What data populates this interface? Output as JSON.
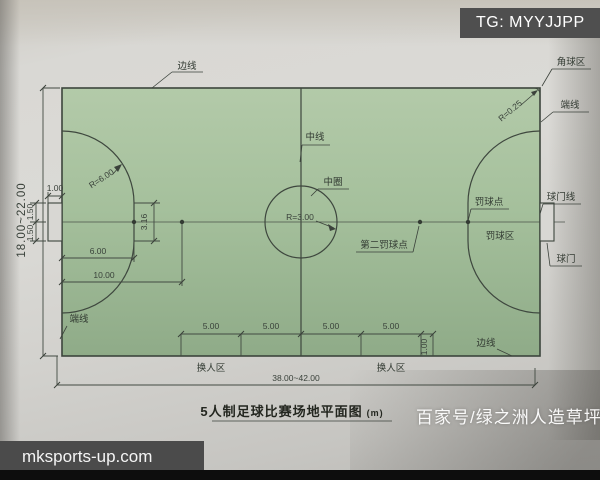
{
  "watermarks": {
    "telegram": "TG: MYYJJPP",
    "site": "mksports-up.com",
    "source": "百家号/绿之洲人造草坪"
  },
  "title": {
    "text": "5人制足球比赛场地平面图",
    "unit": "(m)"
  },
  "labels": {
    "sideline_top": "边线",
    "sideline_bottom": "边线",
    "endline_right": "端线",
    "endline_left": "端线",
    "corner_area": "角球区",
    "center_line": "中线",
    "center_circle": "中圈",
    "second_penalty_point": "第二罚球点",
    "penalty_point": "罚球点",
    "penalty_area": "罚球区",
    "goal_line": "球门线",
    "goal": "球门",
    "substitution_zone_left": "换人区",
    "substitution_zone_right": "换人区"
  },
  "dimensions": {
    "field_width_range": "18.00~22.00",
    "field_length_range": "38.00~42.00",
    "corner_arc_radius": "R=0.25",
    "center_circle_radius": "R=3.00",
    "penalty_arc_radius": "R=6.00",
    "goal_depth": "1.00",
    "goal_half_width_upper": "1.50",
    "goal_half_width_lower": "1.50",
    "arc_flat_length": "3.16",
    "penalty_mark_distance": "6.00",
    "second_penalty_mark_distance": "10.00",
    "sub_zone_seg1": "5.00",
    "sub_zone_seg2": "5.00",
    "sub_zone_seg3": "5.00",
    "sub_zone_seg4": "5.00",
    "sub_zone_offset": "1.00"
  },
  "colors": {
    "field_green": "#a7c29f",
    "paper": "#d6d5d1",
    "line": "#3d443d",
    "watermark_box": "#4e4e4e",
    "watermark_text": "#ffffff"
  }
}
